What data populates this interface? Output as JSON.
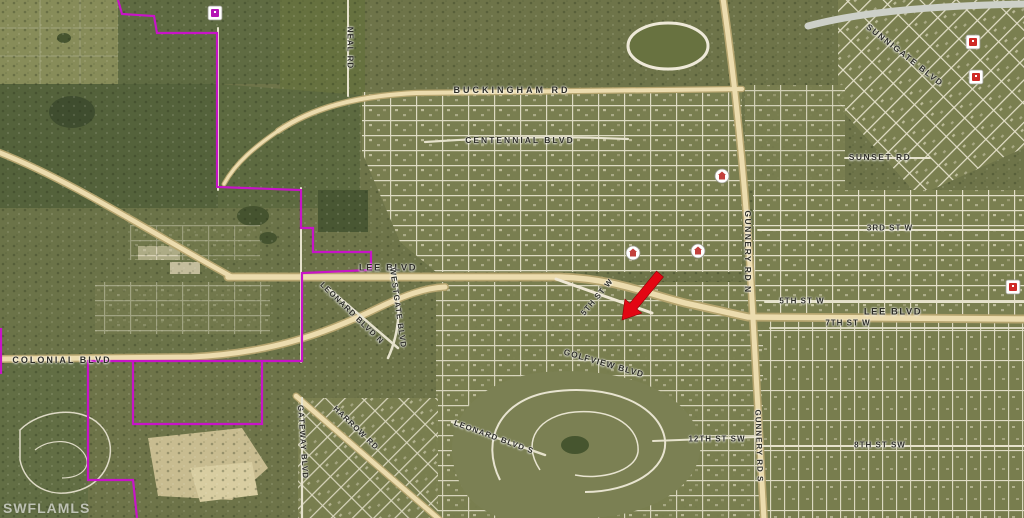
{
  "map": {
    "watermark": "SWFLAMLS",
    "colors": {
      "boundary": "#c714c7",
      "arrow": "#e30613",
      "major_road": "#ecdcae",
      "minor_road": "#e6e2cc",
      "base_terrain": "#6e7449"
    },
    "labels": [
      {
        "id": "buckingham-rd",
        "text": "BUCKINGHAM RD",
        "x": 512,
        "y": 90,
        "rot": 0,
        "fs": 9,
        "ls": 3
      },
      {
        "id": "centennial-blvd",
        "text": "CENTENNIAL BLVD",
        "x": 520,
        "y": 140,
        "rot": 0,
        "fs": 8.5,
        "ls": 2
      },
      {
        "id": "neal-rd",
        "text": "NEAL RD",
        "x": 350,
        "y": 48,
        "rot": 90,
        "fs": 8,
        "ls": 1
      },
      {
        "id": "lee-blvd-west",
        "text": "LEE BLVD",
        "x": 388,
        "y": 268,
        "rot": 0,
        "fs": 9.5,
        "ls": 1.5
      },
      {
        "id": "lee-blvd-east",
        "text": "LEE BLVD",
        "x": 893,
        "y": 312,
        "rot": 0,
        "fs": 9.5,
        "ls": 1.5
      },
      {
        "id": "colonial-blvd",
        "text": "COLONIAL BLVD",
        "x": 62,
        "y": 360,
        "rot": 0,
        "fs": 9,
        "ls": 2
      },
      {
        "id": "sunnigate-blvd",
        "text": "SUNNIGATE BLVD",
        "x": 905,
        "y": 55,
        "rot": 38,
        "fs": 8.5,
        "ls": 1.5
      },
      {
        "id": "sunset-rd",
        "text": "SUNSET RD",
        "x": 880,
        "y": 157,
        "rot": 0,
        "fs": 8.5,
        "ls": 1.5
      },
      {
        "id": "gunnery-rd-n",
        "text": "GUNNERY RD N",
        "x": 748,
        "y": 252,
        "rot": 90,
        "fs": 8.5,
        "ls": 1.5
      },
      {
        "id": "3rd-st-w",
        "text": "3RD ST W",
        "x": 890,
        "y": 228,
        "rot": 0,
        "fs": 8,
        "ls": 1
      },
      {
        "id": "5th-st-w",
        "text": "5TH ST W",
        "x": 802,
        "y": 301,
        "rot": 0,
        "fs": 8,
        "ls": 1
      },
      {
        "id": "7th-st-w",
        "text": "7TH ST W",
        "x": 848,
        "y": 323,
        "rot": 0,
        "fs": 8,
        "ls": 1
      },
      {
        "id": "5th-st-w-diagonal",
        "text": "5TH ST W",
        "x": 597,
        "y": 297,
        "rot": -50,
        "fs": 8,
        "ls": 1
      },
      {
        "id": "leonard-blvd-n",
        "text": "LEONARD BLVD N",
        "x": 352,
        "y": 313,
        "rot": 44,
        "fs": 8,
        "ls": 1
      },
      {
        "id": "westgate-blvd",
        "text": "WESTGATE BLVD",
        "x": 398,
        "y": 308,
        "rot": 82,
        "fs": 8,
        "ls": 1
      },
      {
        "id": "golfview-blvd",
        "text": "GOLFVIEW BLVD",
        "x": 604,
        "y": 363,
        "rot": 16,
        "fs": 8.5,
        "ls": 1
      },
      {
        "id": "leonard-blvd-s",
        "text": "LEONARD BLVD S",
        "x": 494,
        "y": 437,
        "rot": 20,
        "fs": 8,
        "ls": 1
      },
      {
        "id": "gateway-blvd",
        "text": "GATEWAY BLVD",
        "x": 303,
        "y": 442,
        "rot": 86,
        "fs": 8,
        "ls": 1
      },
      {
        "id": "harrow-rd",
        "text": "HARROW RD",
        "x": 356,
        "y": 428,
        "rot": 44,
        "fs": 8,
        "ls": 1
      },
      {
        "id": "gunnery-rd-s",
        "text": "GUNNERY RD S",
        "x": 759,
        "y": 446,
        "rot": 88,
        "fs": 8,
        "ls": 1
      },
      {
        "id": "12th-st-sw",
        "text": "12TH ST SW",
        "x": 717,
        "y": 439,
        "rot": 0,
        "fs": 8,
        "ls": 1
      },
      {
        "id": "8th-st-sw",
        "text": "8TH ST SW",
        "x": 880,
        "y": 445,
        "rot": 0,
        "fs": 8,
        "ls": 1
      }
    ],
    "boundary": {
      "color": "#c714c7",
      "paths": [
        [
          [
            118,
            0
          ],
          [
            122,
            14
          ],
          [
            154,
            16
          ],
          [
            157,
            33
          ],
          [
            217,
            33
          ],
          [
            217,
            187
          ],
          [
            301,
            190
          ],
          [
            301,
            228
          ],
          [
            313,
            228
          ],
          [
            313,
            252
          ],
          [
            371,
            252
          ],
          [
            371,
            270
          ],
          [
            302,
            273
          ],
          [
            302,
            361
          ],
          [
            88,
            361
          ],
          [
            88,
            480
          ],
          [
            133,
            480
          ],
          [
            137,
            518
          ]
        ],
        [
          [
            133,
            361
          ],
          [
            133,
            424
          ],
          [
            262,
            424
          ],
          [
            262,
            361
          ]
        ],
        [
          [
            1,
            328
          ],
          [
            1,
            374
          ]
        ]
      ]
    },
    "marker_arrow": {
      "color": "#e30613",
      "points": "622,320 624.9,299.1 629.9,303.2 656.5,271.1 663.5,276.9 636.9,309 641.9,313.1"
    },
    "icons": [
      {
        "type": "purple-box",
        "x": 215,
        "y": 13
      },
      {
        "type": "red-box",
        "x": 973,
        "y": 42
      },
      {
        "type": "red-box",
        "x": 976,
        "y": 77
      },
      {
        "type": "red-box",
        "x": 1013,
        "y": 287
      },
      {
        "type": "red-circle",
        "x": 633,
        "y": 253
      },
      {
        "type": "red-circle",
        "x": 698,
        "y": 251
      },
      {
        "type": "red-circle",
        "x": 722,
        "y": 176
      }
    ]
  }
}
